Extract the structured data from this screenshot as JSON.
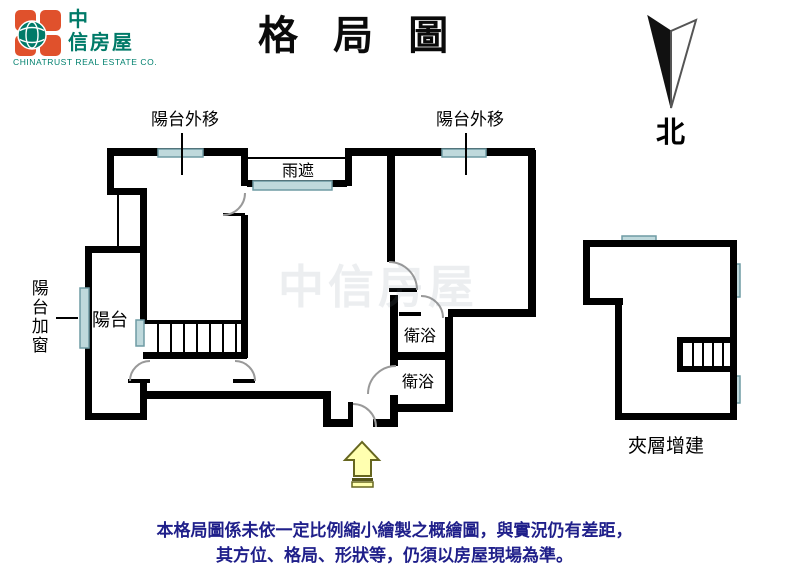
{
  "header": {
    "logo": {
      "cn_line1": "中",
      "cn_line2": "信房屋",
      "subtitle": "CHINATRUST REAL ESTATE CO.",
      "orange": "#E0512C",
      "teal": "#007A68"
    },
    "title": "格 局 圖",
    "compass_label": "北"
  },
  "plan": {
    "labels": {
      "balcony_out_left": "陽台外移",
      "balcony_out_right": "陽台外移",
      "rain_shelter": "雨遮",
      "balcony": "陽台",
      "balcony_add_window": "陽台加窗",
      "bath_upper": "衛浴",
      "bath_lower": "衛浴",
      "mezzanine": "夾層增建"
    },
    "colors": {
      "wall": "#000000",
      "window_fill": "#BFD9DC",
      "window_border": "#6F9BA4",
      "door_arc": "#999999",
      "entry_arrow_fill": "#FFFFB0",
      "entry_arrow_border": "#66661F"
    }
  },
  "watermark": "中信房屋",
  "footer": {
    "line1": "本格局圖係未依一定比例縮小繪製之概繪圖，與實況仍有差距，",
    "line2": "其方位、格局、形狀等，仍須以房屋現場為準。"
  }
}
